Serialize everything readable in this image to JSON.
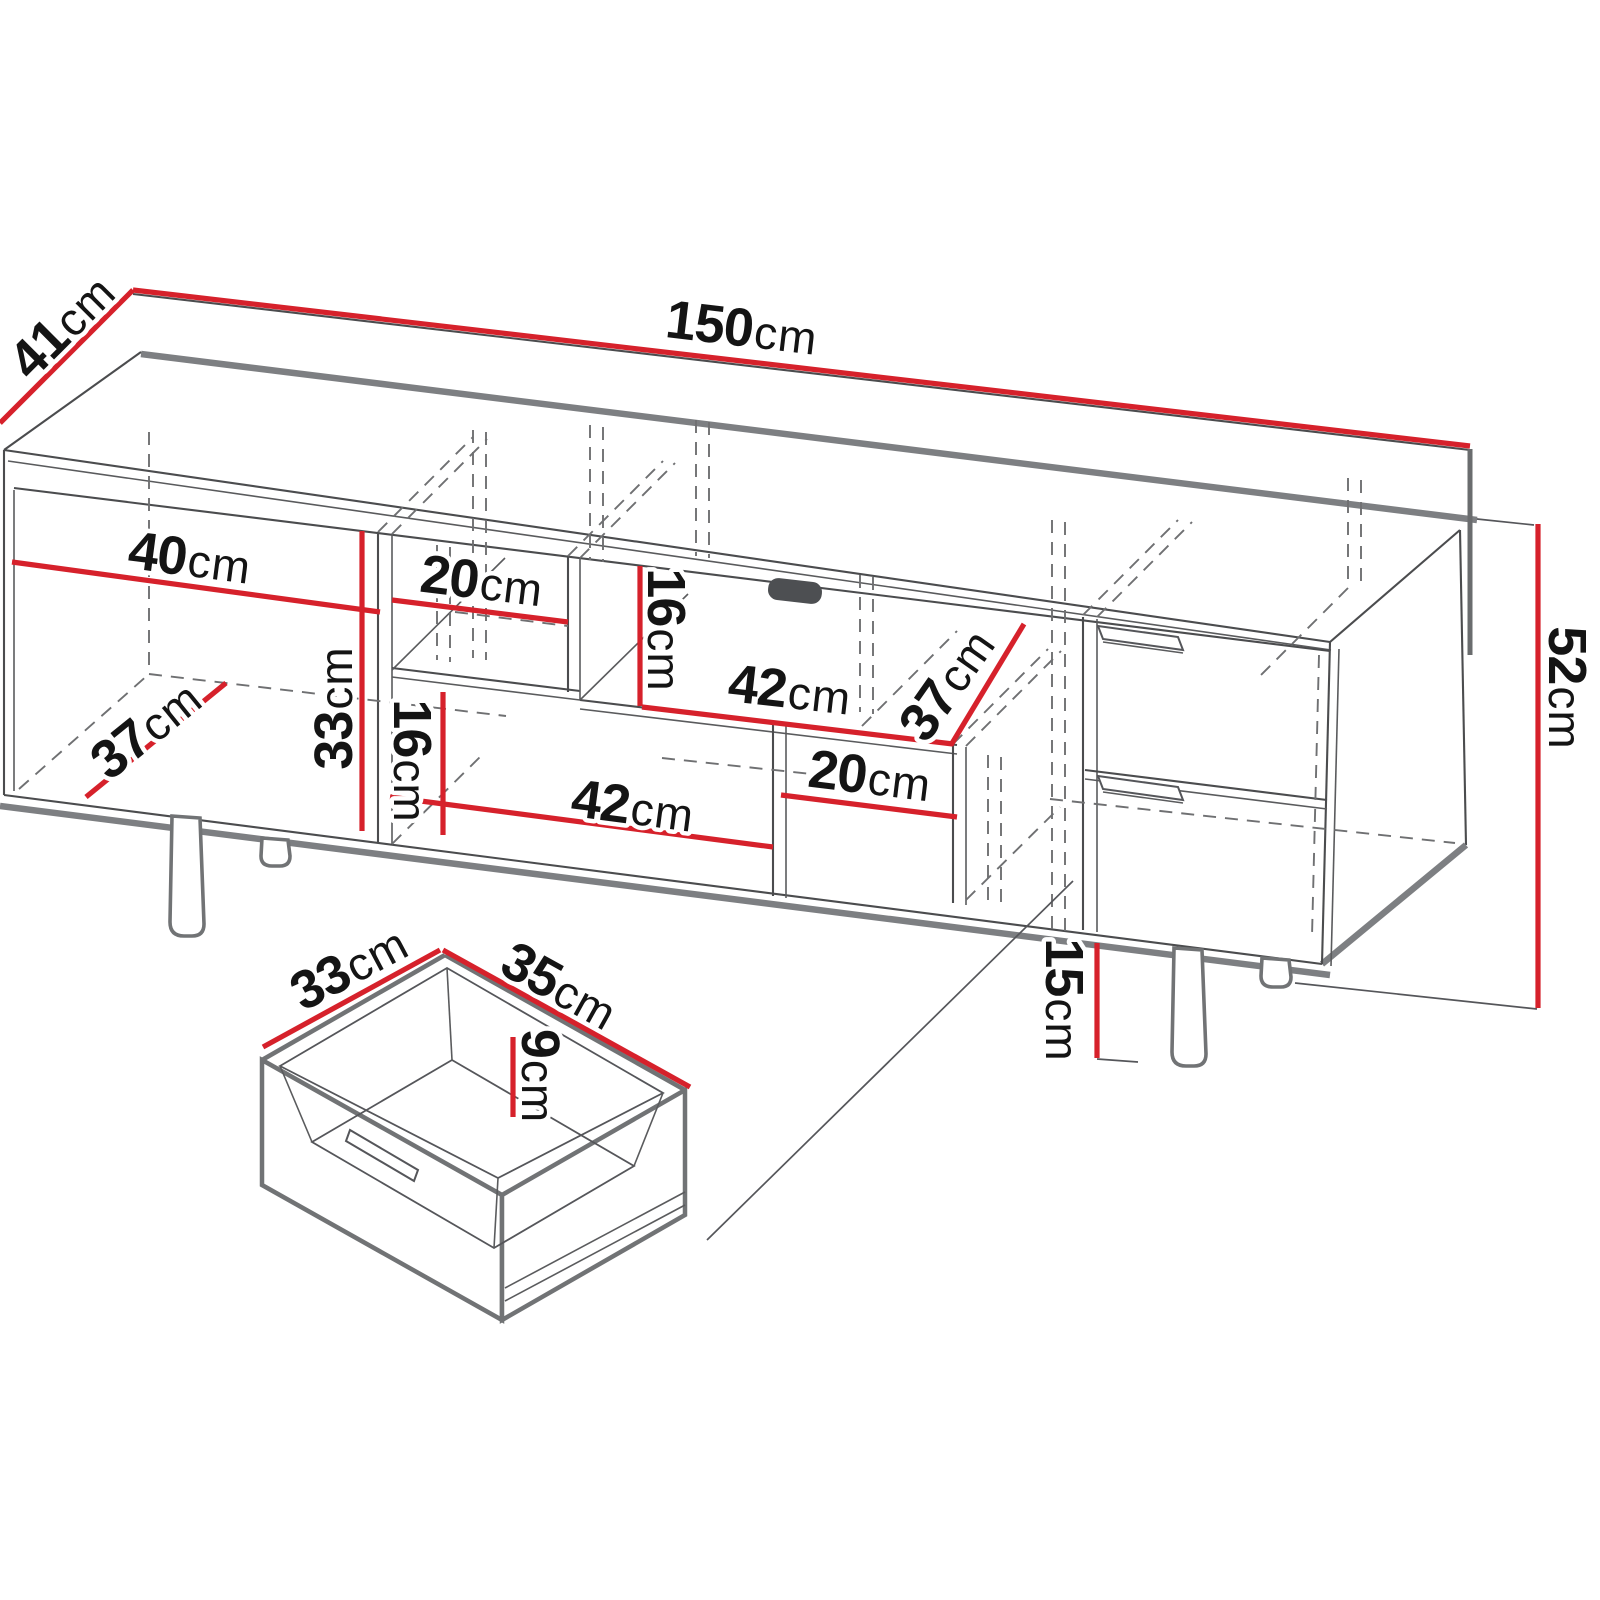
{
  "page": {
    "title": "TV stand technical dimension drawing",
    "background": "#ffffff",
    "unit": "cm"
  },
  "colors": {
    "dimension_line": "#d6212b",
    "outline": "#4b4c4e",
    "outline_thick": "#7d7f82",
    "hidden_edge": "#6f7072",
    "label_text": "#141414",
    "handle_cutout": "#4d4f52"
  },
  "cabinet": {
    "overall": {
      "width": {
        "num": "150",
        "unit": "cm"
      },
      "depth": {
        "num": "41",
        "unit": "cm"
      },
      "height": {
        "num": "52",
        "unit": "cm"
      }
    },
    "interior": {
      "left_width": {
        "num": "40",
        "unit": "cm"
      },
      "left_height": {
        "num": "33",
        "unit": "cm"
      },
      "left_depth": {
        "num": "37",
        "unit": "cm"
      },
      "top_shelf_width": {
        "num": "20",
        "unit": "cm"
      },
      "top_shelf_height": {
        "num": "16",
        "unit": "cm"
      },
      "top_open_width": {
        "num": "42",
        "unit": "cm"
      },
      "mid_depth": {
        "num": "37",
        "unit": "cm"
      },
      "bottom_open_width": {
        "num": "42",
        "unit": "cm"
      },
      "bottom_shelf_height": {
        "num": "16",
        "unit": "cm"
      },
      "bottom_right_width": {
        "num": "20",
        "unit": "cm"
      }
    },
    "legs": {
      "height": {
        "num": "15",
        "unit": "cm"
      }
    }
  },
  "drawer_detail": {
    "depth": {
      "num": "33",
      "unit": "cm"
    },
    "width": {
      "num": "35",
      "unit": "cm"
    },
    "inner_height": {
      "num": "9",
      "unit": "cm"
    }
  }
}
